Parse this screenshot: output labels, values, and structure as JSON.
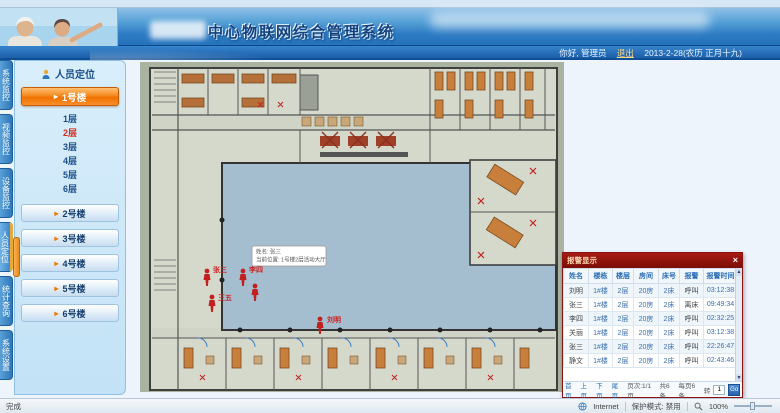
{
  "header": {
    "title": "中心物联网综合管理系统",
    "greeting": "你好, 管理员",
    "logout": "退出",
    "date": "2013-2-28(农历 正月十九)"
  },
  "icons": {
    "arrow": "▸",
    "scroll_up": "▲",
    "scroll_down": "▼",
    "person": "人"
  },
  "sidebar": {
    "tabs": [
      {
        "label": "系统监控"
      },
      {
        "label": "视频监控"
      },
      {
        "label": "设备监控"
      },
      {
        "label": "人员定位"
      },
      {
        "label": "统计查询"
      },
      {
        "label": "系统设置"
      }
    ],
    "panel_title": "人员定位",
    "building_active": "1号楼",
    "floors": [
      "1层",
      "2层",
      "3层",
      "4层",
      "5层",
      "6层"
    ],
    "active_floor": "2层",
    "buildings": [
      "2号楼",
      "3号楼",
      "4号楼",
      "5号楼",
      "6号楼"
    ]
  },
  "floor_plan": {
    "tooltip": {
      "line1": "姓名: 张三",
      "line2": "当前位置: 1号楼2层活动大厅"
    },
    "persons": [
      {
        "name": "张三"
      },
      {
        "name": "李四"
      },
      {
        "name": "王五"
      },
      {
        "name": ""
      },
      {
        "name": "刘明"
      }
    ]
  },
  "alarm_panel": {
    "title": "报警显示",
    "close": "×",
    "columns": [
      "姓名",
      "楼栋",
      "楼层",
      "房间",
      "床号",
      "报警",
      "报警时间"
    ],
    "rows": [
      [
        "刘明",
        "1#楼",
        "2层",
        "20房",
        "2床",
        "呼叫",
        "03:12:38"
      ],
      [
        "张三",
        "1#楼",
        "2层",
        "20房",
        "2床",
        "离床",
        "09:49:34"
      ],
      [
        "李四",
        "1#楼",
        "2层",
        "20房",
        "2床",
        "呼叫",
        "02:32:25"
      ],
      [
        "关丽",
        "1#楼",
        "2层",
        "20房",
        "2床",
        "呼叫",
        "03:12:38"
      ],
      [
        "张三",
        "1#楼",
        "2层",
        "20房",
        "2床",
        "呼叫",
        "22:26:47"
      ],
      [
        "静文",
        "1#楼",
        "2层",
        "20房",
        "2床",
        "呼叫",
        "02:43:46"
      ]
    ],
    "pager": {
      "first": "首页",
      "prev": "上页",
      "next": "下页",
      "last": "尾页",
      "info": "页次:1/1页",
      "total": "共6条",
      "per_page": "每页6条",
      "goto_label": "转",
      "goto_value": "1",
      "go": "Go"
    }
  },
  "status_bar": {
    "left": "完成",
    "zone": "Internet",
    "protected_mode": "保护模式: 禁用",
    "zoom": "100%"
  },
  "colors": {
    "accent_orange": "#f07800",
    "alarm_header_red": "#8a1210",
    "courtyard_blue": "#a4bed0",
    "bed_orange": "#b5703a",
    "active_floor_red": "#d03020"
  }
}
